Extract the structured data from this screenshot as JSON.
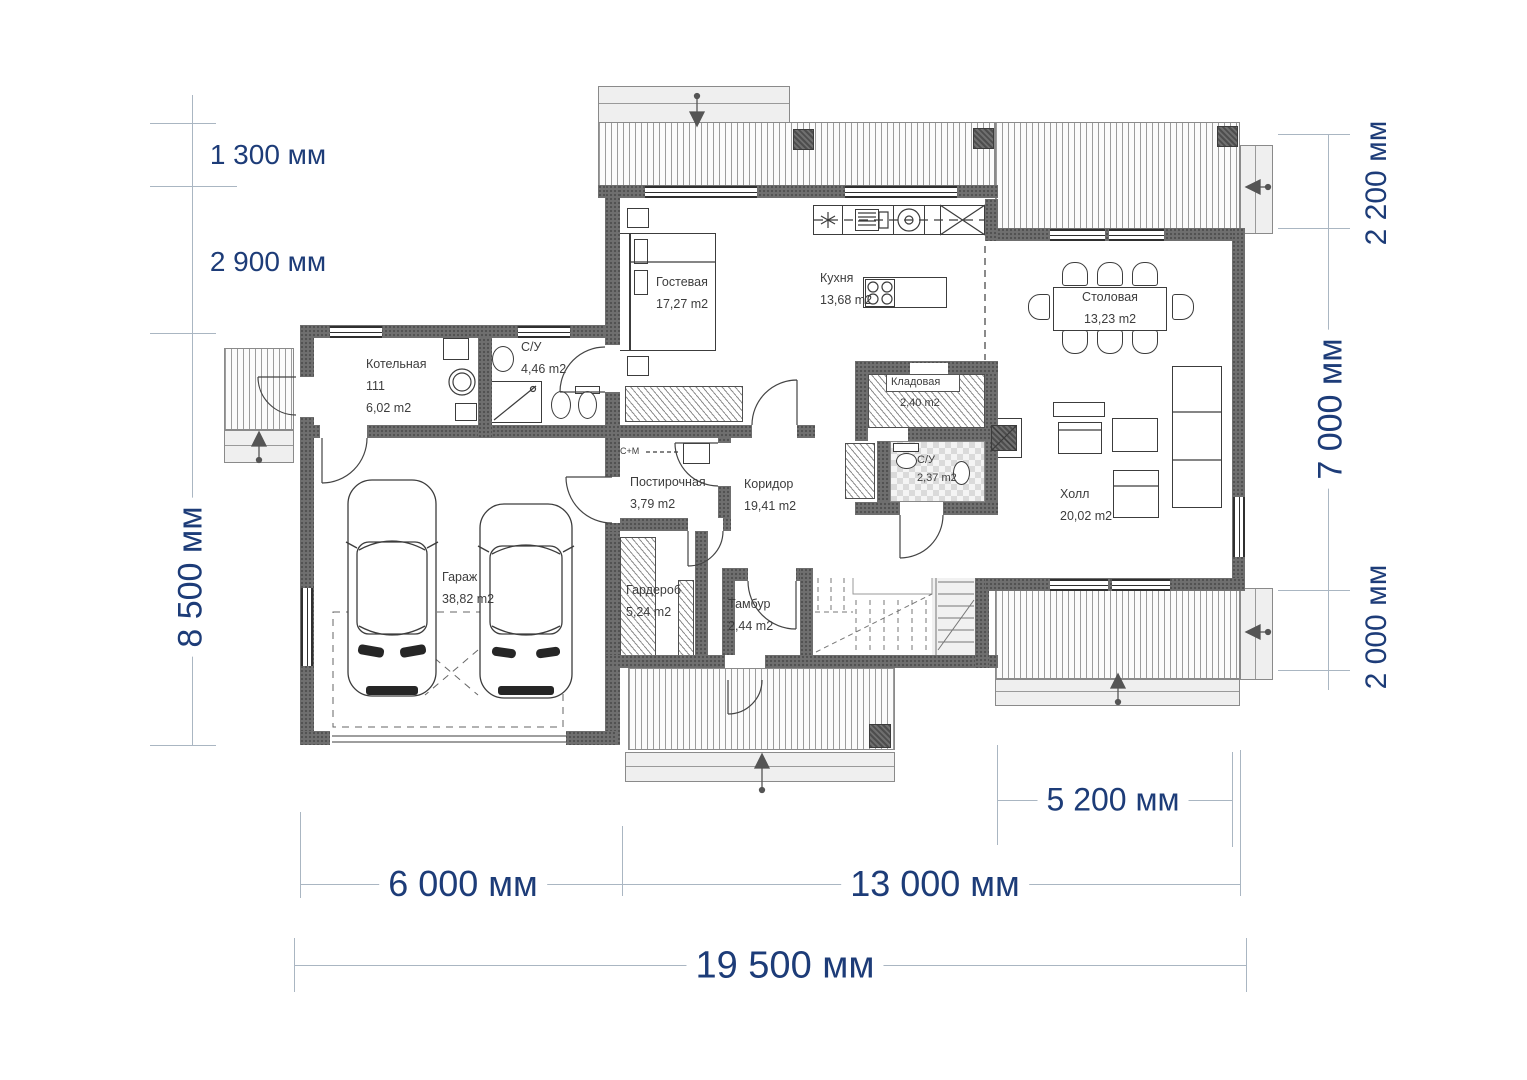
{
  "plan_type": "floor-plan",
  "rooms": {
    "boiler": {
      "name": "Котельная",
      "number": "111",
      "area": "6,02 m2"
    },
    "bath1": {
      "name": "С/У",
      "area": "4,46 m2"
    },
    "guest": {
      "name": "Гостевая",
      "area": "17,27 m2"
    },
    "kitchen": {
      "name": "Кухня",
      "area": "13,68 m2"
    },
    "dining": {
      "name": "Столовая",
      "area": "13,23 m2"
    },
    "pantry": {
      "name": "Кладовая",
      "area": "2,40 m2"
    },
    "bath2": {
      "name": "С/У",
      "area": "2,37 m2"
    },
    "corridor": {
      "name": "Коридор",
      "area": "19,41 m2"
    },
    "laundry": {
      "name": "Постирочная",
      "area": "3,79 m2"
    },
    "wardrobe": {
      "name": "Гардероб",
      "area": "5,24 m2"
    },
    "vestibule": {
      "name": "Тамбур",
      "area": "2,44 m2"
    },
    "hall": {
      "name": "Холл",
      "area": "20,02 m2"
    },
    "garage": {
      "name": "Гараж",
      "area": "38,82 m2"
    }
  },
  "dimensions": {
    "left_top": "1 300 мм",
    "left_mid": "2 900 мм",
    "left_main": "8 500 мм",
    "right_top": "2 200 мм",
    "right_main": "7 000 мм",
    "right_bottom": "2 000 мм",
    "bottom_garage": "6 000 мм",
    "bottom_main": "13 000 мм",
    "bottom_total": "19 500 мм",
    "bottom_terrace": "5 200 мм"
  },
  "labels": {
    "washer_dryer": "С+М"
  },
  "colors": {
    "dimension_text": "#1d3c78",
    "wall": "#6f6f6f",
    "dimension_line": "#aab6c2"
  }
}
